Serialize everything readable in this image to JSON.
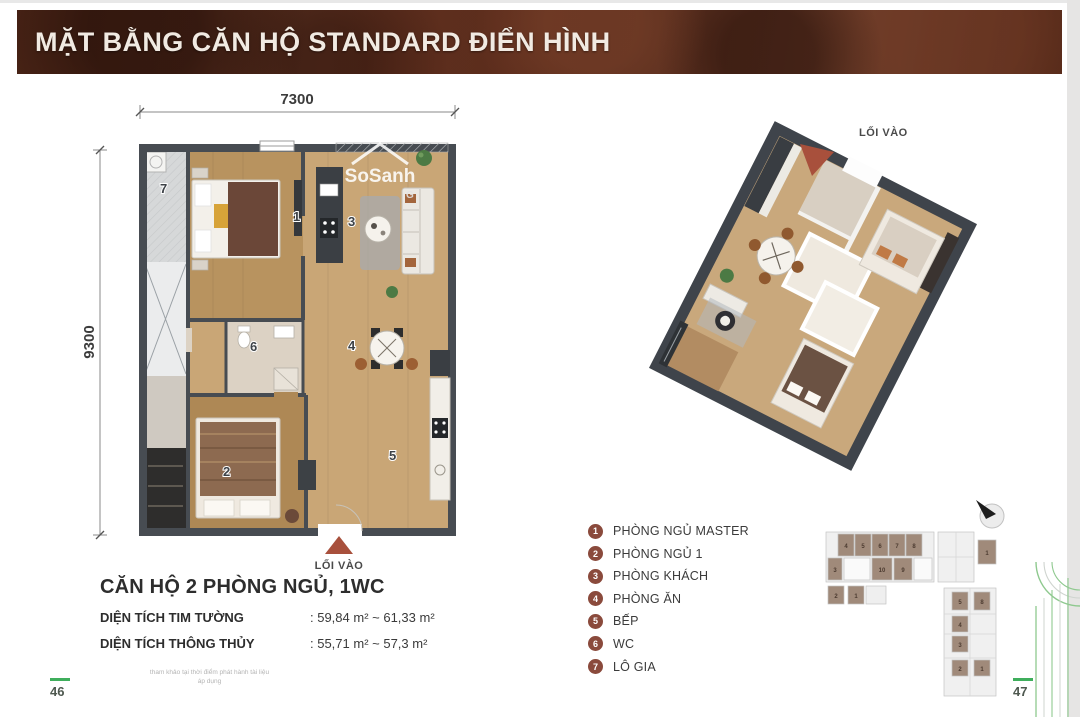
{
  "header": {
    "title": "MẶT BẰNG CĂN HỘ STANDARD ĐIỂN HÌNH"
  },
  "floorplan2d": {
    "dim_width": "7300",
    "dim_height": "9300",
    "entrance_label": "LỐI VÀO",
    "watermark": "SoSanh",
    "watermark_sub": "G",
    "room_numbers": [
      "1",
      "2",
      "3",
      "4",
      "5",
      "6",
      "7"
    ]
  },
  "floorplan3d": {
    "entrance_label": "LỐI VÀO"
  },
  "unit_info": {
    "title": "CĂN HỘ 2 PHÒNG NGỦ, 1WC",
    "rows": [
      {
        "label": "DIỆN TÍCH TIM TƯỜNG",
        "value": ": 59,84 m² ~ 61,33 m²"
      },
      {
        "label": "DIỆN TÍCH THÔNG THỦY",
        "value": ": 55,71 m² ~ 57,3 m²"
      }
    ]
  },
  "legend": {
    "items": [
      {
        "num": "1",
        "label": "PHÒNG NGỦ MASTER"
      },
      {
        "num": "2",
        "label": "PHÒNG NGỦ 1"
      },
      {
        "num": "3",
        "label": "PHÒNG KHÁCH"
      },
      {
        "num": "4",
        "label": "PHÒNG ĂN"
      },
      {
        "num": "5",
        "label": "BẾP"
      },
      {
        "num": "6",
        "label": "WC"
      },
      {
        "num": "7",
        "label": "LÔ GIA"
      }
    ]
  },
  "keyplan": {
    "units": [
      "4",
      "5",
      "6",
      "7",
      "8",
      "3",
      "10",
      "9",
      "2",
      "1",
      "1",
      "5",
      "8",
      "4",
      "3",
      "2",
      "1"
    ]
  },
  "footer": {
    "left_page": "46",
    "right_page": "47",
    "footnote_line1": "tham khảo tại thời điểm phát hành tài liệu",
    "footnote_line2": "áp dụng"
  },
  "colors": {
    "header_bg": "#5a3124",
    "accent_red": "#a8503c",
    "legend_circle": "#8a4a3c",
    "page_green": "#3fae5c",
    "wall": "#474c52",
    "wood": "#c5a174"
  }
}
